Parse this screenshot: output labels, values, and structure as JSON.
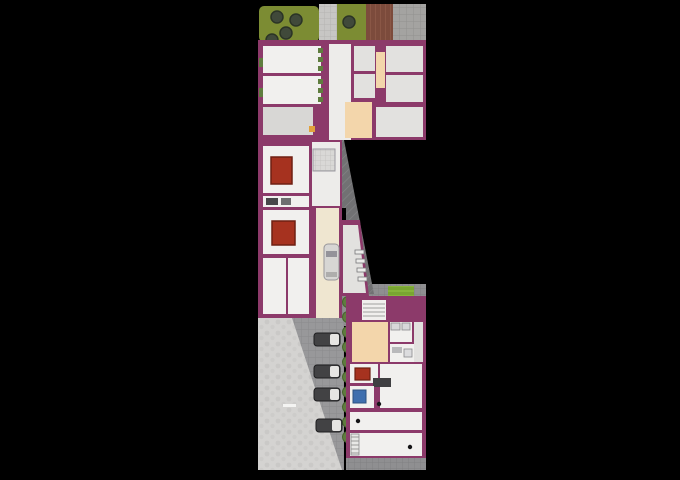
{
  "meta": {
    "type": "architectural-site-plan",
    "background": "#000000"
  },
  "counts": {
    "trees_top_gardens": 5,
    "parked_cars": 4,
    "garage_cars": 1,
    "hedge_bushes": 10,
    "red_rugs": 3
  },
  "palette": {
    "bg": "#000000",
    "wall": "#8c3a6a",
    "floorwhite": "#f1f0ee",
    "floorgray": "#e2e1df",
    "floorgray2": "#d8d7d5",
    "floorcorr": "#edecea",
    "grass": "#7c8c33",
    "tree": "#40493a",
    "treedark": "#2b3426",
    "hedge": "#5f7d3e",
    "hedgedark": "#49622f",
    "peach": "#f3d6ab",
    "cream": "#efe6d0",
    "rug": "#a6321f",
    "rugdark": "#6f1f12",
    "blue": "#3f6fae",
    "cardark": "#424244",
    "carlight": "#e6e5e3"
  },
  "plan": {
    "width": 680,
    "height": 480,
    "shapes": [
      {
        "t": "rect",
        "name": "garden-left",
        "x": 259,
        "y": 6,
        "w": 60,
        "h": 36,
        "rx": 5,
        "f": "grass"
      },
      {
        "t": "rect",
        "name": "walkway-top",
        "x": 319,
        "y": 4,
        "w": 18,
        "h": 38,
        "f": "@stones"
      },
      {
        "t": "rect",
        "name": "garden-mid",
        "x": 337,
        "y": 4,
        "w": 29,
        "h": 38,
        "f": "grass"
      },
      {
        "t": "rect",
        "name": "wood-deck",
        "x": 366,
        "y": 4,
        "w": 27,
        "h": 37,
        "f": "@planks"
      },
      {
        "t": "rect",
        "name": "paving-top-right",
        "x": 393,
        "y": 4,
        "w": 33,
        "h": 37,
        "f": "@pavegrid"
      },
      {
        "t": "circle",
        "name": "tree",
        "cx": 277,
        "cy": 17,
        "r": 6,
        "f": "tree",
        "s": "treedark",
        "sw": 1.5
      },
      {
        "t": "circle",
        "name": "tree",
        "cx": 296,
        "cy": 20,
        "r": 6,
        "f": "tree",
        "s": "treedark",
        "sw": 1.5
      },
      {
        "t": "circle",
        "name": "tree",
        "cx": 286,
        "cy": 33,
        "r": 6,
        "f": "tree",
        "s": "treedark",
        "sw": 1.5
      },
      {
        "t": "circle",
        "name": "tree",
        "cx": 272,
        "cy": 40,
        "r": 6,
        "f": "tree",
        "s": "treedark",
        "sw": 1.5
      },
      {
        "t": "circle",
        "name": "tree",
        "cx": 349,
        "cy": 22,
        "r": 6,
        "f": "tree",
        "s": "treedark",
        "sw": 1.5
      },
      {
        "t": "rect",
        "name": "wall-upper-wing",
        "x": 258,
        "y": 40,
        "w": 168,
        "h": 100,
        "f": "wall"
      },
      {
        "t": "rect",
        "name": "room",
        "x": 263,
        "y": 46,
        "w": 58,
        "h": 27,
        "f": "floorwhite"
      },
      {
        "t": "rect",
        "name": "room",
        "x": 263,
        "y": 76,
        "w": 58,
        "h": 28,
        "f": "floorwhite"
      },
      {
        "t": "rect",
        "name": "room",
        "x": 263,
        "y": 107,
        "w": 50,
        "h": 28,
        "f": "floorgray2"
      },
      {
        "t": "rect",
        "name": "corridor",
        "x": 329,
        "y": 44,
        "w": 22,
        "h": 96,
        "f": "floorcorr"
      },
      {
        "t": "rect",
        "name": "room",
        "x": 354,
        "y": 46,
        "w": 21,
        "h": 25,
        "f": "floorgray"
      },
      {
        "t": "rect",
        "name": "room",
        "x": 354,
        "y": 74,
        "w": 21,
        "h": 24,
        "f": "floorgray"
      },
      {
        "t": "rect",
        "name": "stair-strip",
        "x": 376,
        "y": 52,
        "w": 9,
        "h": 36,
        "f": "peach"
      },
      {
        "t": "rect",
        "name": "room",
        "x": 386,
        "y": 46,
        "w": 37,
        "h": 26,
        "f": "floorgray"
      },
      {
        "t": "rect",
        "name": "room",
        "x": 386,
        "y": 75,
        "w": 37,
        "h": 27,
        "f": "floorgray"
      },
      {
        "t": "rect",
        "name": "stairwell",
        "x": 345,
        "y": 102,
        "w": 27,
        "h": 36,
        "f": "peach"
      },
      {
        "t": "rect",
        "name": "room",
        "x": 376,
        "y": 107,
        "w": 47,
        "h": 30,
        "f": "floorgray"
      },
      {
        "t": "rect",
        "name": "planter",
        "x": 318,
        "y": 48,
        "w": 5,
        "h": 5,
        "f": "hedge"
      },
      {
        "t": "rect",
        "name": "planter",
        "x": 318,
        "y": 57,
        "w": 5,
        "h": 5,
        "f": "hedge"
      },
      {
        "t": "rect",
        "name": "planter",
        "x": 318,
        "y": 66,
        "w": 5,
        "h": 5,
        "f": "hedge"
      },
      {
        "t": "rect",
        "name": "planter",
        "x": 318,
        "y": 79,
        "w": 5,
        "h": 5,
        "f": "hedge"
      },
      {
        "t": "rect",
        "name": "planter",
        "x": 318,
        "y": 88,
        "w": 5,
        "h": 5,
        "f": "hedge"
      },
      {
        "t": "rect",
        "name": "planter",
        "x": 318,
        "y": 97,
        "w": 5,
        "h": 5,
        "f": "hedge"
      },
      {
        "t": "rect",
        "name": "planter",
        "x": 259,
        "y": 58,
        "w": 4,
        "h": 9,
        "f": "hedge"
      },
      {
        "t": "rect",
        "name": "planter",
        "x": 259,
        "y": 88,
        "w": 4,
        "h": 9,
        "f": "hedge"
      },
      {
        "t": "rect",
        "name": "orange-fixture",
        "x": 309,
        "y": 126,
        "w": 6,
        "h": 6,
        "f": "#e2a13c"
      },
      {
        "t": "rect",
        "name": "paving-court",
        "x": 290,
        "y": 284,
        "w": 136,
        "h": 42,
        "f": "@pavegrid2"
      },
      {
        "t": "poly",
        "name": "driveway-ramp",
        "pts": "316,140 344,140 374,294 346,294 346,208 316,208",
        "f": "@hatch"
      },
      {
        "t": "rect",
        "name": "wall-left-wing",
        "x": 258,
        "y": 140,
        "w": 84,
        "h": 178,
        "f": "wall"
      },
      {
        "t": "poly",
        "name": "wall-storage",
        "pts": "340,220 360,220 369,296 340,296",
        "f": "wall"
      },
      {
        "t": "rect",
        "name": "room",
        "x": 263,
        "y": 146,
        "w": 46,
        "h": 47,
        "f": "floorwhite"
      },
      {
        "t": "rect",
        "name": "rug",
        "x": 271,
        "y": 157,
        "w": 21,
        "h": 27,
        "f": "rug",
        "s": "rugdark",
        "sw": 1.5
      },
      {
        "t": "rect",
        "name": "bathroom-strip",
        "x": 263,
        "y": 196,
        "w": 46,
        "h": 11,
        "f": "floorwhite"
      },
      {
        "t": "rect",
        "name": "fixture",
        "x": 266,
        "y": 198,
        "w": 12,
        "h": 7,
        "f": "#474749"
      },
      {
        "t": "rect",
        "name": "fixture",
        "x": 281,
        "y": 198,
        "w": 10,
        "h": 7,
        "f": "#6e6e70"
      },
      {
        "t": "rect",
        "name": "room",
        "x": 263,
        "y": 210,
        "w": 46,
        "h": 44,
        "f": "floorwhite"
      },
      {
        "t": "rect",
        "name": "rug",
        "x": 272,
        "y": 221,
        "w": 23,
        "h": 24,
        "f": "rug",
        "s": "rugdark",
        "sw": 1.5
      },
      {
        "t": "rect",
        "name": "room",
        "x": 263,
        "y": 258,
        "w": 23,
        "h": 56,
        "f": "floorwhite"
      },
      {
        "t": "rect",
        "name": "room",
        "x": 288,
        "y": 258,
        "w": 21,
        "h": 56,
        "f": "floorwhite"
      },
      {
        "t": "rect",
        "name": "hall",
        "x": 312,
        "y": 142,
        "w": 28,
        "h": 64,
        "f": "floorcorr"
      },
      {
        "t": "rect",
        "name": "tiled-bath",
        "x": 313,
        "y": 149,
        "w": 22,
        "h": 22,
        "f": "@tile",
        "s": "#9a99a0",
        "sw": 1
      },
      {
        "t": "rect",
        "name": "garage-lane",
        "x": 316,
        "y": 208,
        "w": 23,
        "h": 110,
        "f": "cream"
      },
      {
        "t": "rect",
        "name": "car-garage-body",
        "x": 324,
        "y": 244,
        "w": 15,
        "h": 36,
        "rx": 4,
        "f": "#d7d6d4",
        "s": "#98979a",
        "sw": 1
      },
      {
        "t": "rect",
        "name": "car-garage-windshield",
        "x": 326,
        "y": 251,
        "w": 11,
        "h": 6,
        "f": "#94939a"
      },
      {
        "t": "rect",
        "name": "car-garage-rear",
        "x": 326,
        "y": 272,
        "w": 11,
        "h": 5,
        "f": "#aeadac"
      },
      {
        "t": "poly",
        "name": "storage-floor",
        "pts": "343,225 358,225 366,293 343,293",
        "f": "floorgray"
      },
      {
        "t": "rect",
        "name": "bike-rack",
        "x": 355,
        "y": 250,
        "w": 9,
        "h": 4,
        "f": "#ececea",
        "s": "#77777a",
        "sw": 0.8
      },
      {
        "t": "rect",
        "name": "bike-rack",
        "x": 356,
        "y": 259,
        "w": 9,
        "h": 4,
        "f": "#ececea",
        "s": "#77777a",
        "sw": 0.8
      },
      {
        "t": "rect",
        "name": "bike-rack",
        "x": 357,
        "y": 268,
        "w": 9,
        "h": 4,
        "f": "#ececea",
        "s": "#77777a",
        "sw": 0.8
      },
      {
        "t": "rect",
        "name": "bike-rack",
        "x": 358,
        "y": 277,
        "w": 9,
        "h": 4,
        "f": "#ececea",
        "s": "#77777a",
        "sw": 0.8
      },
      {
        "t": "rect",
        "name": "parking-paving",
        "x": 292,
        "y": 318,
        "w": 52,
        "h": 152,
        "f": "@parkgrid"
      },
      {
        "t": "poly",
        "name": "gravel-slope",
        "pts": "258,318 292,318 342,470 258,470",
        "f": "@bumps"
      },
      {
        "t": "rect",
        "name": "paint-mark",
        "x": 283,
        "y": 404,
        "w": 13,
        "h": 3,
        "f": "#f4f4f2"
      },
      {
        "t": "circle",
        "name": "hedge-bush",
        "cx": 348,
        "cy": 302,
        "r": 5.5,
        "f": "hedge",
        "s": "hedgedark",
        "sw": 1
      },
      {
        "t": "circle",
        "name": "hedge-bush",
        "cx": 348,
        "cy": 317,
        "r": 5.5,
        "f": "hedge",
        "s": "hedgedark",
        "sw": 1
      },
      {
        "t": "circle",
        "name": "hedge-bush",
        "cx": 348,
        "cy": 332,
        "r": 5.5,
        "f": "hedge",
        "s": "hedgedark",
        "sw": 1
      },
      {
        "t": "circle",
        "name": "hedge-bush",
        "cx": 348,
        "cy": 347,
        "r": 5.5,
        "f": "hedge",
        "s": "hedgedark",
        "sw": 1
      },
      {
        "t": "circle",
        "name": "hedge-bush",
        "cx": 348,
        "cy": 362,
        "r": 5.5,
        "f": "hedge",
        "s": "hedgedark",
        "sw": 1
      },
      {
        "t": "circle",
        "name": "hedge-bush",
        "cx": 348,
        "cy": 377,
        "r": 5.5,
        "f": "hedge",
        "s": "hedgedark",
        "sw": 1
      },
      {
        "t": "circle",
        "name": "hedge-bush",
        "cx": 348,
        "cy": 392,
        "r": 5.5,
        "f": "hedge",
        "s": "hedgedark",
        "sw": 1
      },
      {
        "t": "circle",
        "name": "hedge-bush",
        "cx": 348,
        "cy": 407,
        "r": 5.5,
        "f": "hedge",
        "s": "hedgedark",
        "sw": 1
      },
      {
        "t": "circle",
        "name": "hedge-bush",
        "cx": 348,
        "cy": 422,
        "r": 5.5,
        "f": "hedge",
        "s": "hedgedark",
        "sw": 1
      },
      {
        "t": "circle",
        "name": "hedge-bush",
        "cx": 348,
        "cy": 437,
        "r": 5.5,
        "f": "hedge",
        "s": "hedgedark",
        "sw": 1
      },
      {
        "t": "rect",
        "name": "car-body",
        "x": 314,
        "y": 333,
        "w": 26,
        "h": 13,
        "rx": 3,
        "f": "cardark",
        "s": "#1e1e20",
        "sw": 1
      },
      {
        "t": "rect",
        "name": "car-front",
        "x": 330,
        "y": 334,
        "w": 9,
        "h": 11,
        "rx": 2,
        "f": "carlight"
      },
      {
        "t": "rect",
        "name": "car-body",
        "x": 314,
        "y": 365,
        "w": 26,
        "h": 13,
        "rx": 3,
        "f": "cardark",
        "s": "#1e1e20",
        "sw": 1
      },
      {
        "t": "rect",
        "name": "car-front",
        "x": 330,
        "y": 366,
        "w": 9,
        "h": 11,
        "rx": 2,
        "f": "carlight"
      },
      {
        "t": "rect",
        "name": "car-body",
        "x": 314,
        "y": 388,
        "w": 26,
        "h": 13,
        "rx": 3,
        "f": "cardark",
        "s": "#1e1e20",
        "sw": 1
      },
      {
        "t": "rect",
        "name": "car-front",
        "x": 330,
        "y": 389,
        "w": 9,
        "h": 11,
        "rx": 2,
        "f": "carlight"
      },
      {
        "t": "rect",
        "name": "car-body",
        "x": 316,
        "y": 419,
        "w": 26,
        "h": 13,
        "rx": 3,
        "f": "cardark",
        "s": "#1e1e20",
        "sw": 1
      },
      {
        "t": "rect",
        "name": "car-front",
        "x": 332,
        "y": 420,
        "w": 9,
        "h": 11,
        "rx": 2,
        "f": "carlight"
      },
      {
        "t": "rect",
        "name": "garden-bright",
        "x": 388,
        "y": 286,
        "w": 26,
        "h": 36,
        "f": "@gstripes"
      },
      {
        "t": "rect",
        "name": "wall-lower-wing",
        "x": 346,
        "y": 296,
        "w": 80,
        "h": 162,
        "f": "wall"
      },
      {
        "t": "rect",
        "name": "entry-steps",
        "x": 362,
        "y": 300,
        "w": 24,
        "h": 20,
        "f": "#f0efed"
      },
      {
        "t": "line",
        "name": "step-line",
        "x1": 363,
        "y1": 304,
        "x2": 385,
        "y2": 304,
        "s": "#a0a09e",
        "sw": 1
      },
      {
        "t": "line",
        "name": "step-line",
        "x1": 363,
        "y1": 308,
        "x2": 385,
        "y2": 308,
        "s": "#a0a09e",
        "sw": 1
      },
      {
        "t": "line",
        "name": "step-line",
        "x1": 363,
        "y1": 312,
        "x2": 385,
        "y2": 312,
        "s": "#a0a09e",
        "sw": 1
      },
      {
        "t": "line",
        "name": "step-line",
        "x1": 363,
        "y1": 316,
        "x2": 385,
        "y2": 316,
        "s": "#a0a09e",
        "sw": 1
      },
      {
        "t": "rect",
        "name": "hall-peach",
        "x": 352,
        "y": 322,
        "w": 36,
        "h": 40,
        "f": "peach"
      },
      {
        "t": "rect",
        "name": "bathroom",
        "x": 390,
        "y": 322,
        "w": 22,
        "h": 20,
        "f": "floorwhite"
      },
      {
        "t": "rect",
        "name": "fixture",
        "x": 391,
        "y": 323,
        "w": 9,
        "h": 7,
        "f": "#d8d8da",
        "s": "#8a8a8c",
        "sw": 0.8
      },
      {
        "t": "rect",
        "name": "fixture",
        "x": 402,
        "y": 323,
        "w": 8,
        "h": 7,
        "f": "#d8d8da",
        "s": "#8a8a8c",
        "sw": 0.8
      },
      {
        "t": "rect",
        "name": "bathroom",
        "x": 390,
        "y": 344,
        "w": 24,
        "h": 18,
        "f": "floorwhite"
      },
      {
        "t": "rect",
        "name": "fixture",
        "x": 392,
        "y": 347,
        "w": 10,
        "h": 6,
        "f": "#b9b9bb"
      },
      {
        "t": "rect",
        "name": "fixture",
        "x": 404,
        "y": 349,
        "w": 8,
        "h": 8,
        "f": "#dcdcde",
        "s": "#8a8a8c",
        "sw": 0.8
      },
      {
        "t": "rect",
        "name": "room",
        "x": 414,
        "y": 322,
        "w": 9,
        "h": 40,
        "f": "floorgray"
      },
      {
        "t": "rect",
        "name": "room",
        "x": 350,
        "y": 364,
        "w": 28,
        "h": 19,
        "f": "floorwhite"
      },
      {
        "t": "rect",
        "name": "rug",
        "x": 355,
        "y": 368,
        "w": 15,
        "h": 12,
        "f": "rug",
        "s": "rugdark",
        "sw": 1.2
      },
      {
        "t": "rect",
        "name": "room",
        "x": 380,
        "y": 364,
        "w": 42,
        "h": 44,
        "f": "floorwhite"
      },
      {
        "t": "rect",
        "name": "kitchen-counter",
        "x": 373,
        "y": 378,
        "w": 18,
        "h": 9,
        "f": "#3f3f41"
      },
      {
        "t": "rect",
        "name": "room",
        "x": 350,
        "y": 386,
        "w": 24,
        "h": 22,
        "f": "floorwhite"
      },
      {
        "t": "rect",
        "name": "blue-fixture",
        "x": 353,
        "y": 390,
        "w": 13,
        "h": 13,
        "f": "blue",
        "s": "#2c5280",
        "sw": 1
      },
      {
        "t": "rect",
        "name": "room",
        "x": 350,
        "y": 412,
        "w": 72,
        "h": 18,
        "f": "floorwhite"
      },
      {
        "t": "rect",
        "name": "room",
        "x": 350,
        "y": 433,
        "w": 72,
        "h": 23,
        "f": "floorwhite"
      },
      {
        "t": "rect",
        "name": "stairs",
        "x": 351,
        "y": 434,
        "w": 8,
        "h": 21,
        "f": "@rungs",
        "s": "#8a8a8c",
        "sw": 0.8
      },
      {
        "t": "circle",
        "name": "column",
        "cx": 358,
        "cy": 421,
        "r": 2.2,
        "f": "#141416"
      },
      {
        "t": "circle",
        "name": "column",
        "cx": 379,
        "cy": 404,
        "r": 2.2,
        "f": "#141416"
      },
      {
        "t": "circle",
        "name": "column",
        "cx": 410,
        "cy": 447,
        "r": 2.2,
        "f": "#141416"
      },
      {
        "t": "rect",
        "name": "paving-south",
        "x": 346,
        "y": 458,
        "w": 80,
        "h": 12,
        "f": "@pavegrid2"
      }
    ]
  }
}
